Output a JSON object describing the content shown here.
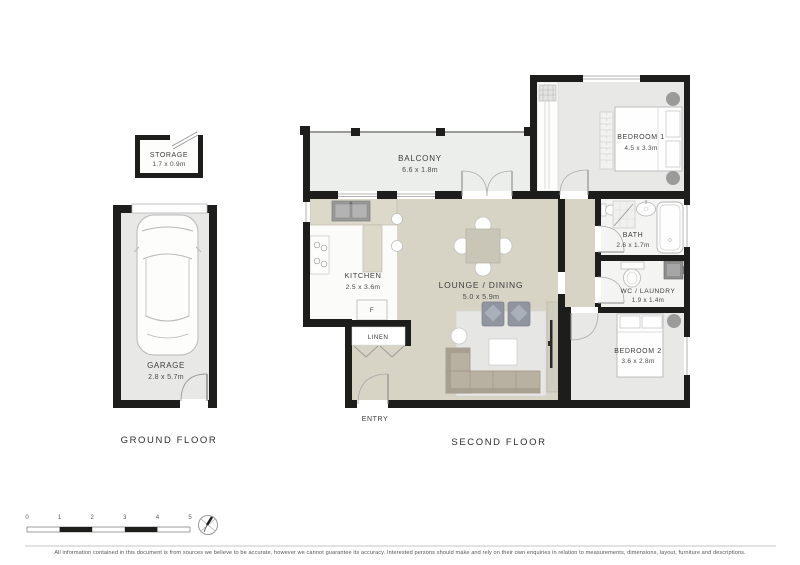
{
  "floors": {
    "ground": {
      "label": "GROUND FLOOR",
      "storage": {
        "name": "STORAGE",
        "dims": "1.7 x 0.9m"
      },
      "garage": {
        "name": "GARAGE",
        "dims": "2.8 x 5.7m"
      }
    },
    "second": {
      "label": "SECOND FLOOR",
      "balcony": {
        "name": "BALCONY",
        "dims": "6.6 x 1.8m"
      },
      "bedroom1": {
        "name": "BEDROOM 1",
        "dims": "4.5 x 3.3m"
      },
      "kitchen": {
        "name": "KITCHEN",
        "dims": "2.5 x 3.6m"
      },
      "lounge_dining": {
        "name": "LOUNGE / DINING",
        "dims": "5.0 x 5.9m"
      },
      "bath": {
        "name": "BATH",
        "dims": "2.6 x 1.7m"
      },
      "wc_laundry": {
        "name": "WC / LAUNDRY",
        "dims": "1.9 x 1.4m"
      },
      "bedroom2": {
        "name": "BEDROOM 2",
        "dims": "3.6 x 2.8m"
      },
      "linen": {
        "name": "LINEN"
      },
      "entry": {
        "name": "ENTRY"
      },
      "fridge_label": "F"
    }
  },
  "scale_bar": {
    "ticks": [
      "0",
      "1",
      "2",
      "3",
      "4",
      "5"
    ]
  },
  "disclaimer": "All information contained in this document is from sources we believe to be accurate, however we cannot guarantee its accuracy. Interested persons should make and rely on their own enquiries in relation to measurements, dimensions, layout, furniture and descriptions.",
  "colors": {
    "wall": "#1d1d1b",
    "floor_beige": "#d7d3c5",
    "floor_grey": "#e8e8e6",
    "balcony_grey": "#eceeeb",
    "furniture_grey": "#9b9b9b"
  }
}
